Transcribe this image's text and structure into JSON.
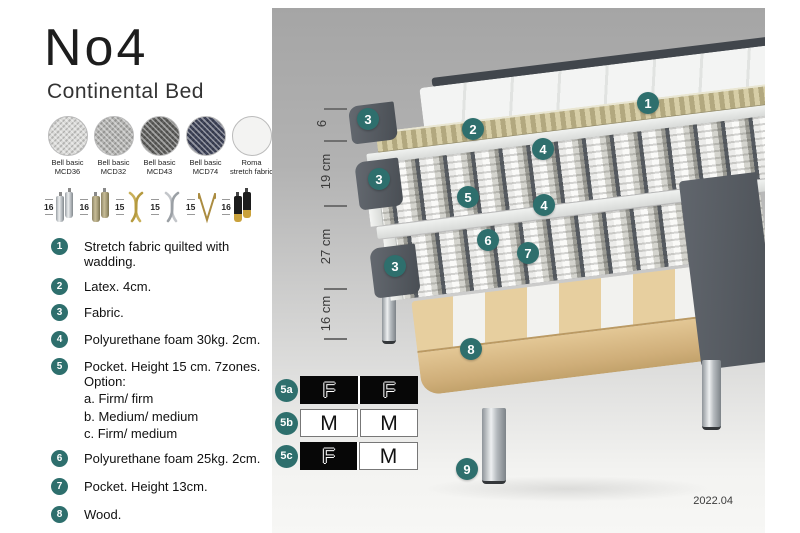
{
  "title": "No4",
  "subtitle": "Continental Bed",
  "fabrics": [
    {
      "line1": "Bell basic",
      "line2": "MCD36",
      "color": "#d9d9d7"
    },
    {
      "line1": "Bell basic",
      "line2": "MCD32",
      "color": "#b3b3b1"
    },
    {
      "line1": "Bell basic",
      "line2": "MCD43",
      "color": "#5f5f5d"
    },
    {
      "line1": "Bell basic",
      "line2": "MCD74",
      "color": "#3f4459"
    },
    {
      "line1": "Roma",
      "line2": "stretch fabric",
      "color": "#f3f3f2"
    }
  ],
  "legs": [
    {
      "height": "16",
      "type": "cylinder-chrome"
    },
    {
      "height": "16",
      "type": "cylinder-brass"
    },
    {
      "height": "15",
      "type": "twist-gold"
    },
    {
      "height": "15",
      "type": "twist-silver"
    },
    {
      "height": "15",
      "type": "hairpin-gold"
    },
    {
      "height": "16",
      "type": "cylinder-black-gold"
    }
  ],
  "legend": [
    {
      "num": "1",
      "text": "Stretch fabric quilted with wadding."
    },
    {
      "num": "2",
      "text": "Latex. 4cm."
    },
    {
      "num": "3",
      "text": "Fabric."
    },
    {
      "num": "4",
      "text": "Polyurethane foam 30kg. 2cm."
    },
    {
      "num": "5",
      "text": "Pocket. Height 15 cm. 7zones. Option:",
      "sub": [
        "a. Firm/ firm",
        "b. Medium/ medium",
        "c. Firm/ medium"
      ]
    },
    {
      "num": "6",
      "text": "Polyurethane foam 25kg. 2cm."
    },
    {
      "num": "7",
      "text": "Pocket. Height 13cm."
    },
    {
      "num": "8",
      "text": "Wood."
    },
    {
      "num": "9",
      "text": "Metal leg. Height 16cm."
    }
  ],
  "dimensions": [
    "6",
    "19 cm",
    "27 cm",
    "16 cm"
  ],
  "diagram_badges": {
    "b1": "1",
    "b2": "2",
    "b3": "3",
    "b4": "4",
    "b5": "5",
    "b6": "6",
    "b7": "7",
    "b8": "8",
    "b9": "9"
  },
  "firmness_options": [
    {
      "id": "5a",
      "cells": [
        {
          "letter": "F",
          "fill": "black"
        },
        {
          "letter": "F",
          "fill": "black"
        }
      ]
    },
    {
      "id": "5b",
      "cells": [
        {
          "letter": "M",
          "fill": "white"
        },
        {
          "letter": "M",
          "fill": "white"
        }
      ]
    },
    {
      "id": "5c",
      "cells": [
        {
          "letter": "F",
          "fill": "black"
        },
        {
          "letter": "M",
          "fill": "white"
        }
      ]
    }
  ],
  "version": "2022.04",
  "colors": {
    "badge_teal": "#2e6f6d",
    "panel_gray_top": "#a5a5a5",
    "panel_gray_bottom": "#f7f7f5",
    "latex_tan": "#c2b88f",
    "wood": "#ddc191",
    "upholstery_dark": "#51565c"
  }
}
